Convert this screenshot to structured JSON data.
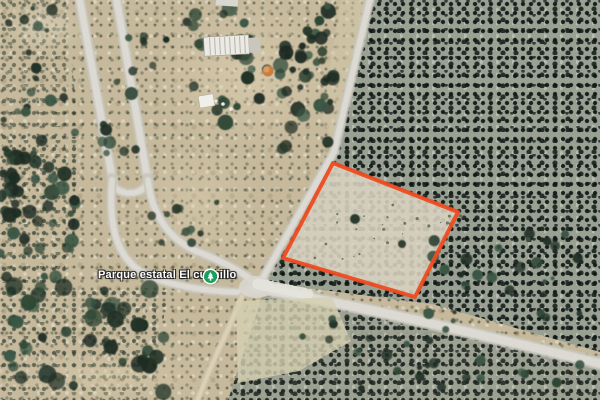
{
  "map": {
    "view_label": "satellite-imagery",
    "poi": {
      "label": "Parque estatal El cuchillo",
      "icon": "park-tree-icon",
      "icon_color": "#16a05c"
    },
    "parcel_outline": {
      "color": "#ee4b20"
    }
  }
}
